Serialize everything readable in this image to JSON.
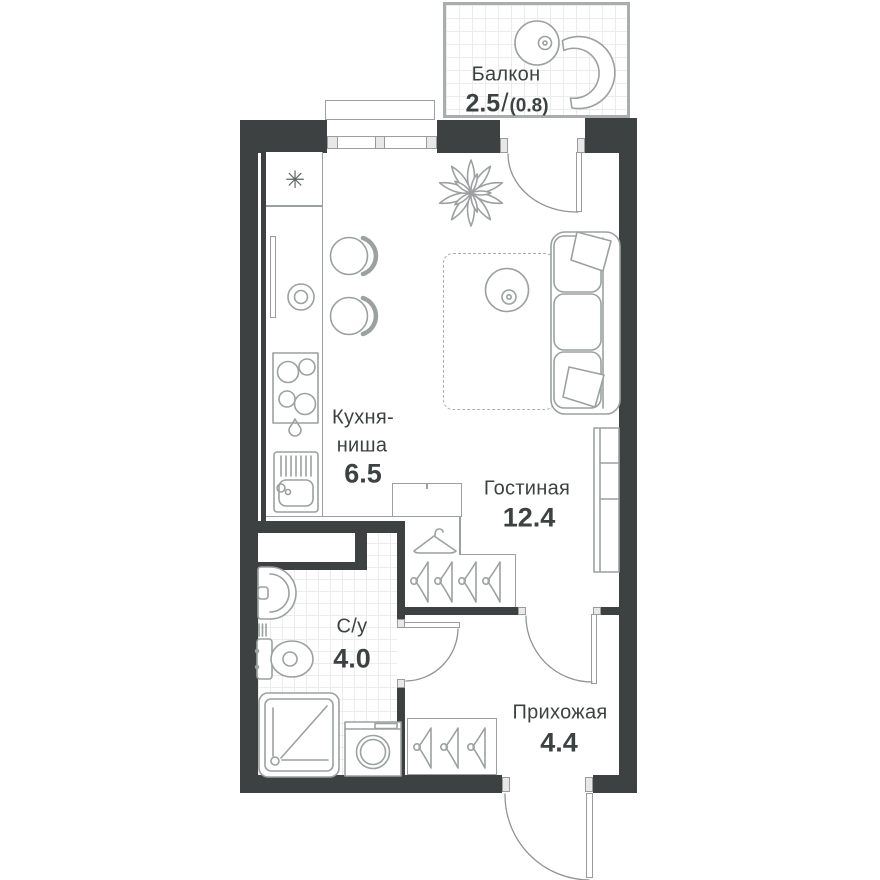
{
  "title": "Studio apartment floor plan",
  "rooms": {
    "balcony": {
      "label": "Балкон",
      "area": "2.5",
      "separator": "/",
      "area_secondary": "(0.8)"
    },
    "kitchen": {
      "label_line1": "Кухня-",
      "label_line2": "ниша",
      "area": "6.5"
    },
    "living": {
      "label": "Гостиная",
      "area": "12.4"
    },
    "bathroom": {
      "label": "С/у",
      "area": "4.0"
    },
    "hallway": {
      "label": "Прихожая",
      "area": "4.4"
    }
  },
  "icons": {
    "fridge_snowflake": "✳"
  },
  "colors": {
    "wall": "#3e4141",
    "fixture_stroke": "#9ba1a0",
    "tile_line": "#ececec",
    "text": "#3c4242"
  }
}
